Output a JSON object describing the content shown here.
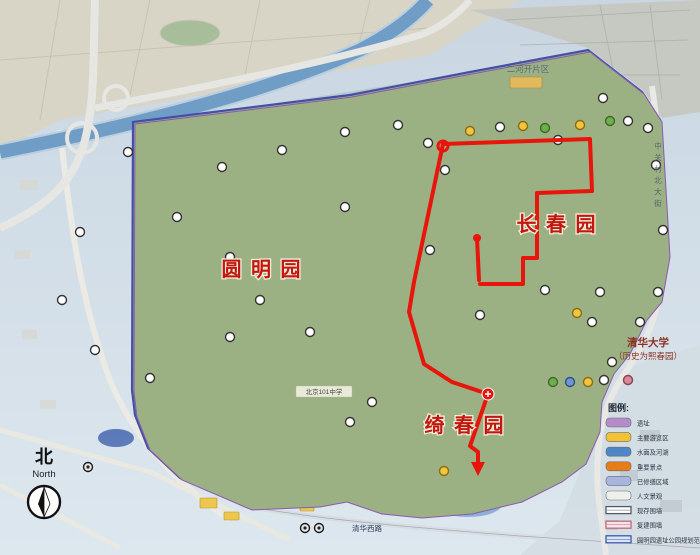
{
  "map": {
    "colors": {
      "page_top": "#c9d6e2",
      "page_bottom": "#dde7ee",
      "park_green": "#9cb183",
      "water": "#a9bdd9",
      "river": "#6f9dc6",
      "boundary_blue": "#4450a8",
      "boundary_purple": "#8a5ab0",
      "urban_grey": "#b3b7b1",
      "urban_beige": "#d8d5c7",
      "orange_zone": "#e0793a",
      "route_red": "#e8150c"
    },
    "garden_labels": [
      {
        "text": "圆 明 园",
        "x": 262,
        "y": 276,
        "size": 20
      },
      {
        "text": "长 春 园",
        "x": 557,
        "y": 231,
        "size": 20
      },
      {
        "text": "绮 春 园",
        "x": 465,
        "y": 432,
        "size": 20
      }
    ],
    "labels": {
      "tsinghua_line1": "清华大学",
      "tsinghua_line2": "（历史为熙春园）",
      "erhekai": "二河开片区",
      "school": "北京101中学",
      "road_south": "清华西路",
      "street_east": "中关村北大街"
    },
    "compass": {
      "cn": "北",
      "en": "North"
    },
    "legend": {
      "title": "图例:",
      "items": [
        {
          "label": "遗址",
          "type": "fill",
          "color": "#b48cc8"
        },
        {
          "label": "主要游览区",
          "type": "fill",
          "color": "#f2c233"
        },
        {
          "label": "水面及河湖",
          "type": "fill",
          "color": "#4f86c6"
        },
        {
          "label": "重要景点",
          "type": "fill",
          "color": "#e87c16"
        },
        {
          "label": "已修缮区域",
          "type": "fill",
          "color": "#a9b5df"
        },
        {
          "label": "人文景观",
          "type": "fill",
          "color": "#f0f0ea"
        },
        {
          "label": "现存围墙",
          "type": "line",
          "color": "#555a60",
          "fill": "#ffffff"
        },
        {
          "label": "复建围墙",
          "type": "line",
          "color": "#c06a7c",
          "fill": "#f6e3e9"
        },
        {
          "label": "圆明园遗址公园规划范围线",
          "type": "line",
          "color": "#3a5aa8",
          "fill": "#d9e4f5"
        }
      ]
    },
    "route": {
      "color": "#e8150c",
      "width": 4,
      "lines": [
        [
          [
            443,
            144
          ],
          [
            590,
            139
          ],
          [
            592,
            191
          ],
          [
            537,
            193
          ],
          [
            537,
            258
          ],
          [
            523,
            258
          ],
          [
            523,
            284
          ],
          [
            480,
            284
          ]
        ],
        [
          [
            477,
            238
          ],
          [
            479,
            280
          ]
        ],
        [
          [
            443,
            144
          ],
          [
            414,
            282
          ],
          [
            409,
            312
          ],
          [
            424,
            364
          ],
          [
            452,
            382
          ],
          [
            488,
            394
          ],
          [
            470,
            446
          ],
          [
            478,
            452
          ],
          [
            478,
            464
          ]
        ]
      ],
      "start_ring": [
        443,
        146
      ],
      "spur_dot": [
        477,
        238
      ],
      "cross_marker": [
        488,
        394
      ],
      "arrow": [
        [
          471,
          462
        ],
        [
          485,
          462
        ],
        [
          478,
          476
        ]
      ]
    },
    "markers": [
      {
        "x": 128,
        "y": 152,
        "t": "w"
      },
      {
        "x": 80,
        "y": 232,
        "t": "w"
      },
      {
        "x": 62,
        "y": 300,
        "t": "w"
      },
      {
        "x": 95,
        "y": 350,
        "t": "w"
      },
      {
        "x": 150,
        "y": 378,
        "t": "w"
      },
      {
        "x": 88,
        "y": 467,
        "t": "d"
      },
      {
        "x": 230,
        "y": 337,
        "t": "w"
      },
      {
        "x": 310,
        "y": 332,
        "t": "w"
      },
      {
        "x": 230,
        "y": 257,
        "t": "w"
      },
      {
        "x": 177,
        "y": 217,
        "t": "w"
      },
      {
        "x": 222,
        "y": 167,
        "t": "w"
      },
      {
        "x": 282,
        "y": 150,
        "t": "w"
      },
      {
        "x": 345,
        "y": 132,
        "t": "w"
      },
      {
        "x": 398,
        "y": 125,
        "t": "w"
      },
      {
        "x": 428,
        "y": 143,
        "t": "w"
      },
      {
        "x": 470,
        "y": 131,
        "t": "y"
      },
      {
        "x": 500,
        "y": 127,
        "t": "w"
      },
      {
        "x": 523,
        "y": 126,
        "t": "y"
      },
      {
        "x": 545,
        "y": 128,
        "t": "g"
      },
      {
        "x": 558,
        "y": 140,
        "t": "w"
      },
      {
        "x": 580,
        "y": 125,
        "t": "y"
      },
      {
        "x": 610,
        "y": 121,
        "t": "g"
      },
      {
        "x": 628,
        "y": 121,
        "t": "w"
      },
      {
        "x": 648,
        "y": 128,
        "t": "w"
      },
      {
        "x": 603,
        "y": 98,
        "t": "w"
      },
      {
        "x": 656,
        "y": 165,
        "t": "w"
      },
      {
        "x": 663,
        "y": 230,
        "t": "w"
      },
      {
        "x": 658,
        "y": 292,
        "t": "w"
      },
      {
        "x": 600,
        "y": 292,
        "t": "w"
      },
      {
        "x": 545,
        "y": 290,
        "t": "w"
      },
      {
        "x": 430,
        "y": 250,
        "t": "w"
      },
      {
        "x": 345,
        "y": 207,
        "t": "w"
      },
      {
        "x": 260,
        "y": 300,
        "t": "w"
      },
      {
        "x": 592,
        "y": 322,
        "t": "w"
      },
      {
        "x": 640,
        "y": 322,
        "t": "w"
      },
      {
        "x": 612,
        "y": 362,
        "t": "w"
      },
      {
        "x": 553,
        "y": 382,
        "t": "g"
      },
      {
        "x": 570,
        "y": 382,
        "t": "b"
      },
      {
        "x": 588,
        "y": 382,
        "t": "y"
      },
      {
        "x": 604,
        "y": 380,
        "t": "w"
      },
      {
        "x": 628,
        "y": 380,
        "t": "p"
      },
      {
        "x": 577,
        "y": 313,
        "t": "y"
      },
      {
        "x": 350,
        "y": 422,
        "t": "w"
      },
      {
        "x": 372,
        "y": 402,
        "t": "w"
      },
      {
        "x": 480,
        "y": 315,
        "t": "w"
      },
      {
        "x": 445,
        "y": 170,
        "t": "w"
      },
      {
        "x": 444,
        "y": 471,
        "t": "y"
      },
      {
        "x": 305,
        "y": 528,
        "t": "d"
      },
      {
        "x": 319,
        "y": 528,
        "t": "d"
      }
    ]
  }
}
